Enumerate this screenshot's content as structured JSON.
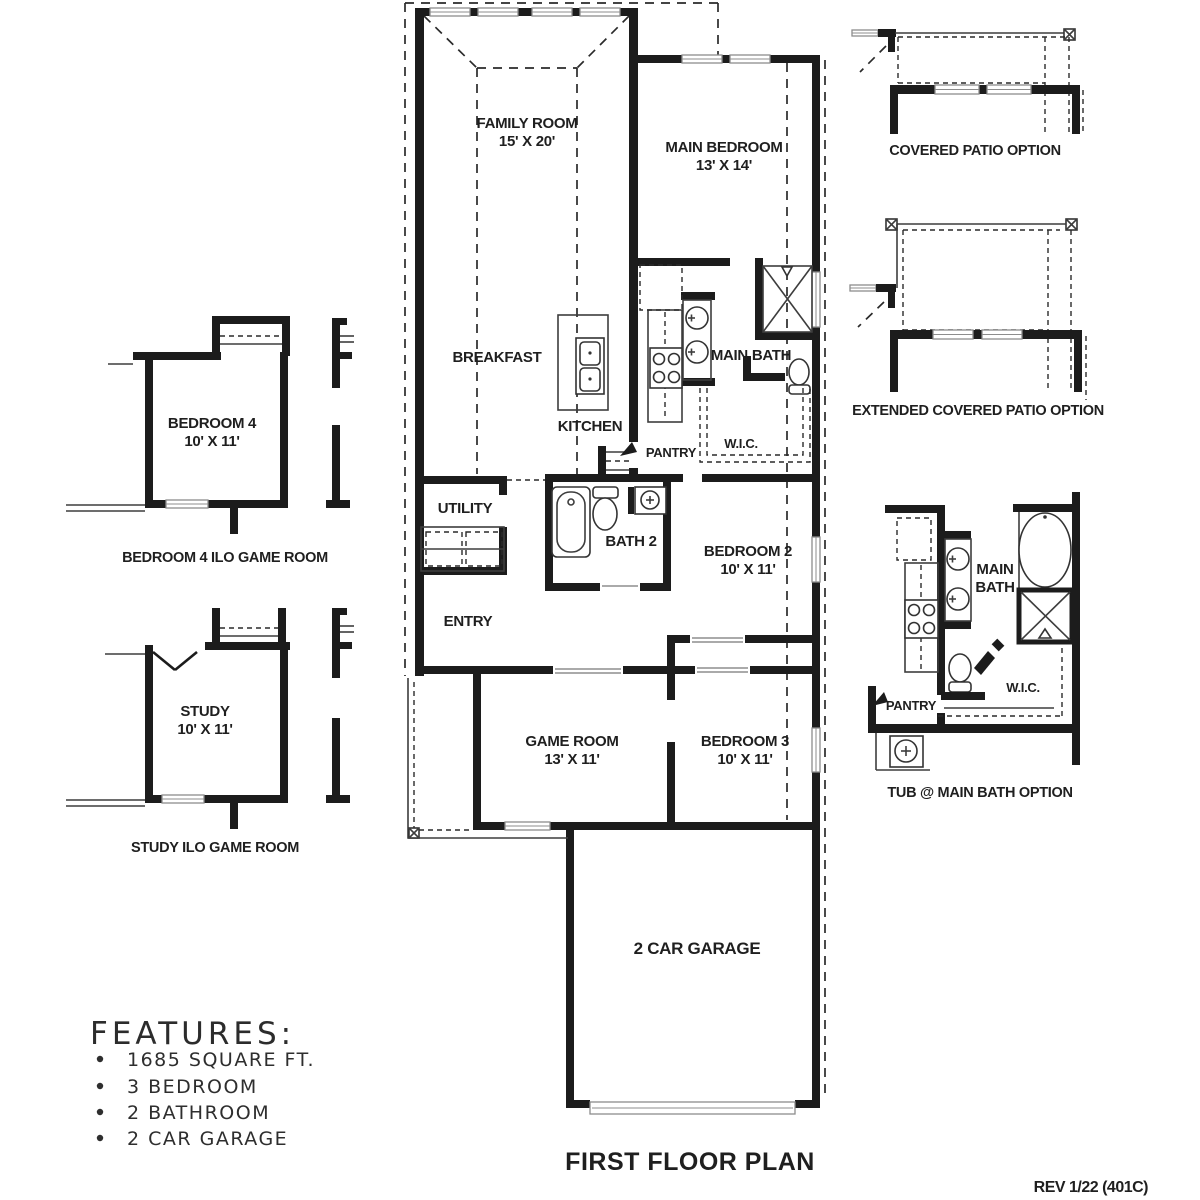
{
  "plan": {
    "title": "FIRST FLOOR PLAN",
    "revision": "REV 1/22 (401C)"
  },
  "features": {
    "heading": "FEATURES:",
    "items": [
      "1685 SQUARE FT.",
      "3 BEDROOM",
      "2 BATHROOM",
      "2 CAR GARAGE"
    ]
  },
  "rooms": {
    "family_room": {
      "name": "FAMILY ROOM",
      "dims": "15' X 20'"
    },
    "main_bedroom": {
      "name": "MAIN BEDROOM",
      "dims": "13' X 14'"
    },
    "breakfast": {
      "name": "BREAKFAST"
    },
    "kitchen": {
      "name": "KITCHEN"
    },
    "pantry": {
      "name": "PANTRY"
    },
    "main_bath": {
      "name": "MAIN BATH"
    },
    "wic": {
      "name": "W.I.C."
    },
    "utility": {
      "name": "UTILITY"
    },
    "bath_2": {
      "name": "BATH 2"
    },
    "bedroom_2": {
      "name": "BEDROOM 2",
      "dims": "10' X 11'"
    },
    "entry": {
      "name": "ENTRY"
    },
    "game_room": {
      "name": "GAME ROOM",
      "dims": "13' X 11'"
    },
    "bedroom_3": {
      "name": "BEDROOM 3",
      "dims": "10' X 11'"
    },
    "garage": {
      "name": "2 CAR GARAGE"
    }
  },
  "options": {
    "covered_patio": {
      "caption": "COVERED PATIO OPTION"
    },
    "extended_patio": {
      "caption": "EXTENDED COVERED PATIO OPTION"
    },
    "bedroom_4": {
      "name": "BEDROOM 4",
      "dims": "10' X 11'",
      "caption": "BEDROOM 4 ILO GAME ROOM"
    },
    "study": {
      "name": "STUDY",
      "dims": "10' X 11'",
      "caption": "STUDY ILO GAME ROOM"
    },
    "tub_main_bath": {
      "caption": "TUB @ MAIN BATH OPTION",
      "main_bath_line1": "MAIN",
      "main_bath_line2": "BATH",
      "wic": "W.I.C.",
      "pantry": "PANTRY"
    }
  }
}
